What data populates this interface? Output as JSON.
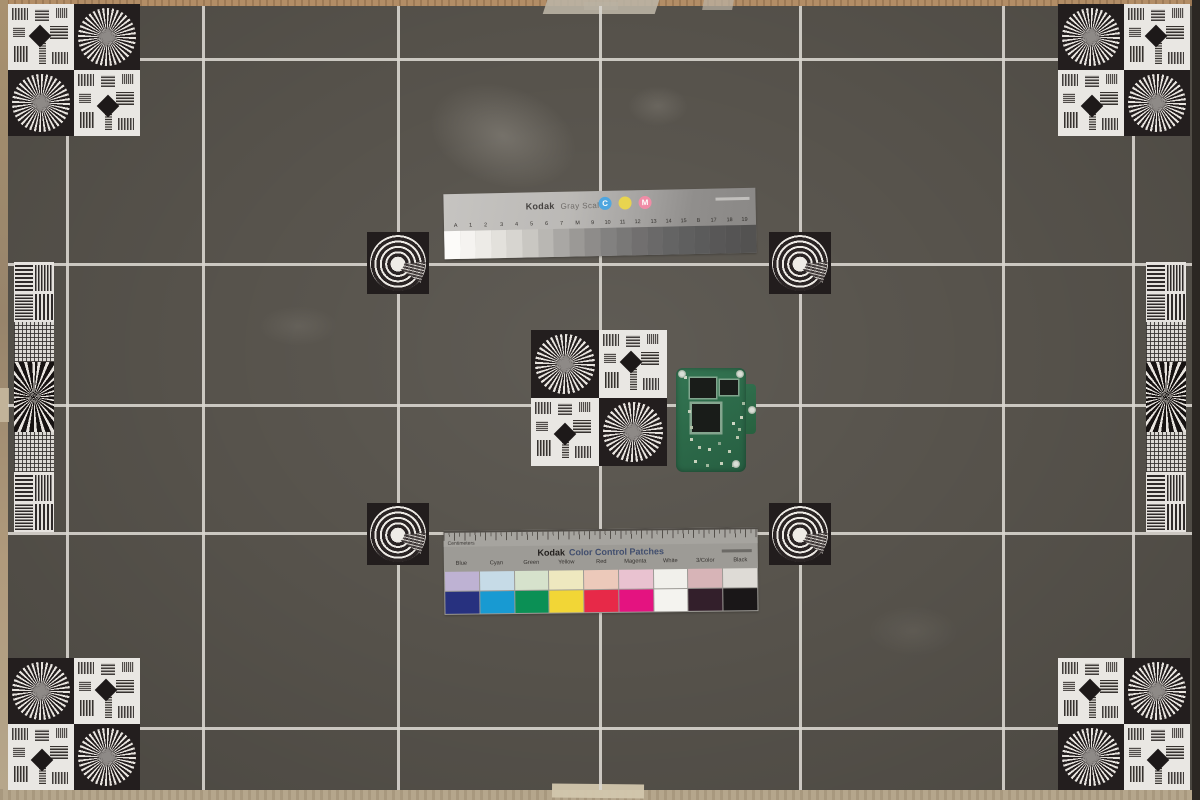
{
  "scene": {
    "subject": "Camera resolution and color test chart photographed on a dark gray board",
    "board_color": "#57534c",
    "grid_line_color": "#d8d5ce"
  },
  "gray_scale": {
    "brand": "Kodak",
    "title": "Gray Scale",
    "dots": [
      {
        "label": "C",
        "color": "#4fa6df"
      },
      {
        "label": "",
        "color": "#e8d44f"
      },
      {
        "label": "M",
        "color": "#f08ca6"
      }
    ],
    "step_labels": [
      "A",
      "1",
      "2",
      "3",
      "4",
      "5",
      "6",
      "7",
      "M",
      "9",
      "10",
      "11",
      "12",
      "13",
      "14",
      "15",
      "B",
      "17",
      "18",
      "19"
    ],
    "step_colors": [
      "#fcfbf9",
      "#f5f3f0",
      "#edebe7",
      "#e3e1dc",
      "#d7d5d0",
      "#c9c7c2",
      "#b9b7b3",
      "#a9a7a4",
      "#9b9996",
      "#8e8c8a",
      "#828180",
      "#797877",
      "#716f6f",
      "#6a6969",
      "#646464",
      "#5f5f5f",
      "#5b5b5b",
      "#585757",
      "#555454",
      "#535251"
    ]
  },
  "color_patches": {
    "brand": "Kodak",
    "title": "Color Control Patches",
    "ruler_label": "Centimeters",
    "labels": [
      "Blue",
      "Cyan",
      "Green",
      "Yellow",
      "Red",
      "Magenta",
      "White",
      "3/Color",
      "Black"
    ],
    "tints": [
      "#beb2d3",
      "#c6dbe7",
      "#d6e2cc",
      "#eee8bf",
      "#ecc9ba",
      "#e9c2d0",
      "#f1f0eb",
      "#d7b4b7",
      "#dedbd6"
    ],
    "solids": [
      "#27317f",
      "#189ad2",
      "#0b9055",
      "#f2d636",
      "#e72948",
      "#e41380",
      "#f4f3ef",
      "#331f2b",
      "#1a1718"
    ]
  }
}
